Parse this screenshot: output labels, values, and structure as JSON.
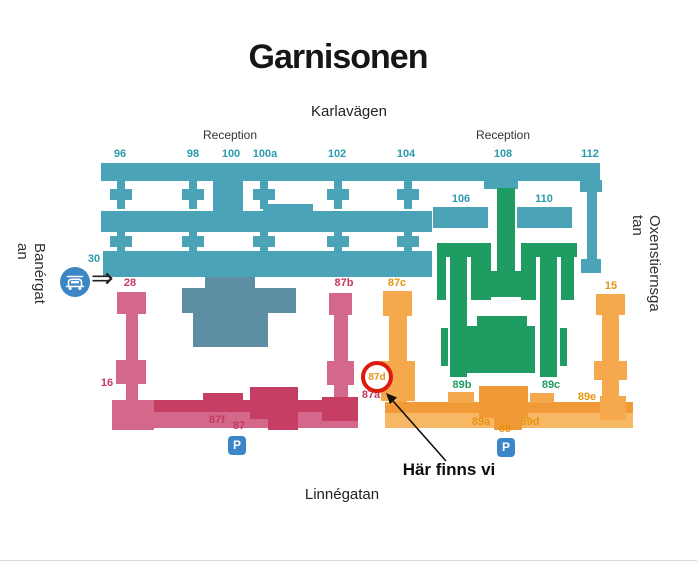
{
  "title": "Garnisonen",
  "streets": {
    "top": "Karlavägen",
    "bottom": "Linnégatan",
    "left_lines": [
      "Banérgat",
      "an"
    ],
    "right_lines": [
      "Oxenstiernsga",
      "tan"
    ]
  },
  "reception": {
    "left": "Reception",
    "right": "Reception"
  },
  "numbers": {
    "teal": {
      "n96": "96",
      "n98": "98",
      "n100": "100",
      "n100a": "100a",
      "n102": "102",
      "n104": "104",
      "n106": "106",
      "n108": "108",
      "n110": "110",
      "n112": "112",
      "n30": "30"
    },
    "pink": {
      "n28": "28",
      "n16": "16",
      "n87b": "87b",
      "n87f": "87f",
      "n87": "87",
      "n87a": "87a"
    },
    "orange": {
      "n87c": "87c",
      "n87d": "87d",
      "n15": "15",
      "n89e": "89e",
      "n89a": "89a",
      "n89": "89",
      "n89d": "89d"
    },
    "green": {
      "n89b": "89b",
      "n89c": "89c"
    }
  },
  "annotation": {
    "text": "Här finns vi",
    "circled": "87d"
  },
  "parking": {
    "left": "P",
    "right": "P"
  },
  "icons": {
    "car": "car-icon",
    "entrance_arrow": "⇒",
    "parking": "P"
  },
  "colors": {
    "teal": "#4AA3B7",
    "teal_text": "#2B9AAD",
    "slate": "#5E8EA4",
    "green": "#1E9C62",
    "pink": "#D4688A",
    "pink_dark": "#C63E64",
    "pink_text": "#C53A60",
    "orange": "#F5A94C",
    "orange_dark": "#F09A38",
    "orange_text": "#E8920F",
    "icon_blue": "#3B86C6",
    "marker_red": "#DD1B0C"
  }
}
